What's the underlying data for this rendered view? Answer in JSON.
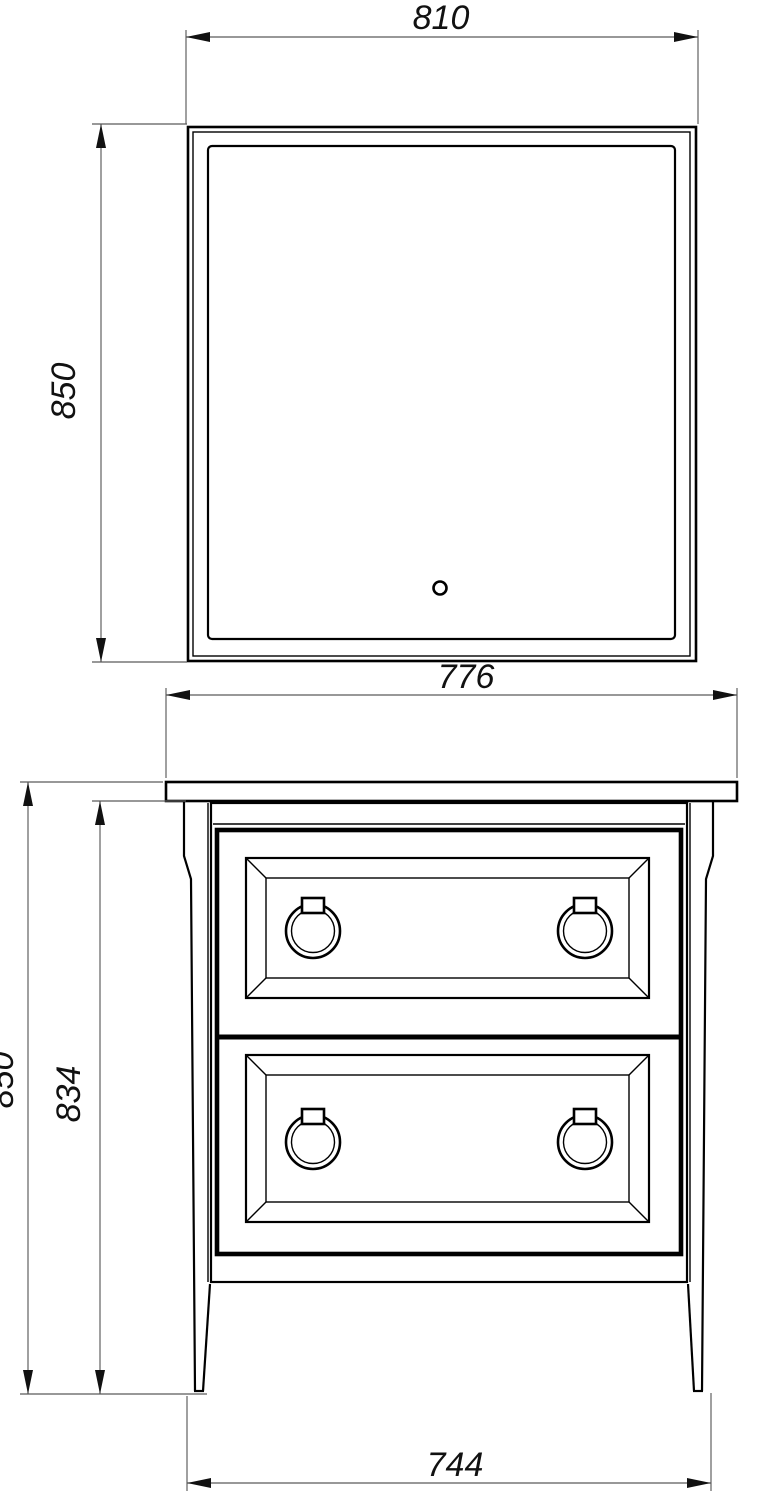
{
  "drawing": {
    "type": "technical-dimension-drawing",
    "subject": "Bathroom vanity set, front view: LED mirror above a two-drawer cabinet with ring pulls",
    "units": "mm",
    "mirror_view": {
      "width_label": "810",
      "height_label": "850"
    },
    "cabinet_view": {
      "countertop_width_label": "776",
      "overall_height_label": "850",
      "body_height_label": "834",
      "feet_width_label": "744"
    },
    "colors": {
      "outline": "#000000",
      "dimension_lines": "#5a5a5a",
      "text": "#111111",
      "background": "#ffffff"
    }
  }
}
